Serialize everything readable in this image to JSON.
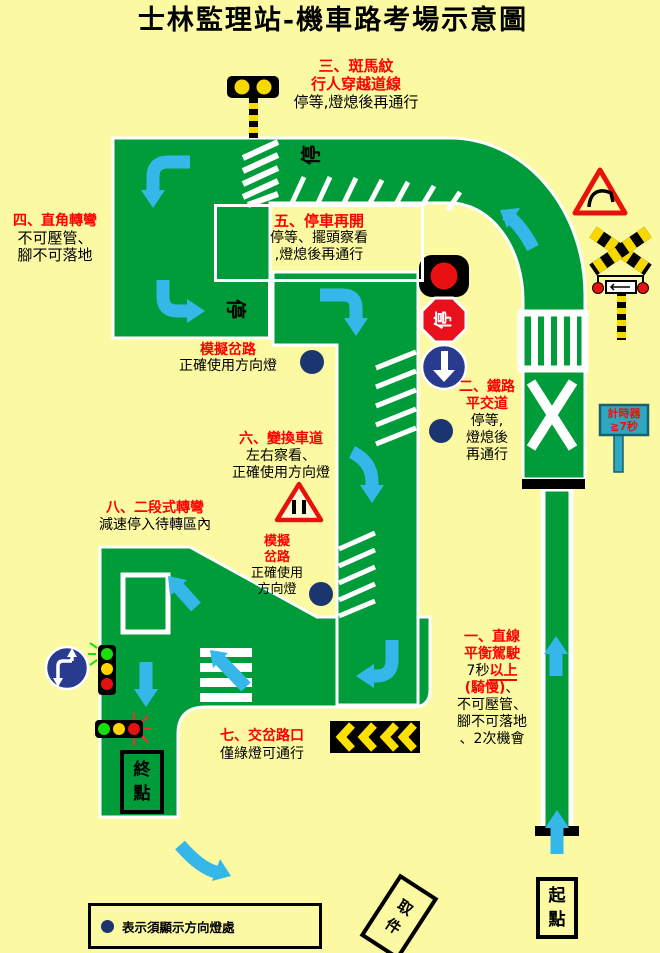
{
  "title": "士林監理站-機車路考場示意圖",
  "sections": {
    "s1": {
      "h1": "一、直線",
      "h2": "平衡駕駛",
      "b1a": "7秒",
      "b1b": "以上",
      "b2a": "(騎慢)",
      "b2b": "、",
      "b3": "不可壓管、",
      "b4": "腳不可落地",
      "b5": "、2次機會"
    },
    "s2": {
      "h1": "二、鐵路",
      "h2": "平交道",
      "b1": "停等,",
      "b2": "燈熄後",
      "b3": "再通行"
    },
    "s3": {
      "h1": "三、斑馬紋",
      "h2": "行人穿越道線",
      "b1": "停等,燈熄後再通行"
    },
    "s4": {
      "h1": "四、直角轉彎",
      "b1": "不可壓管、",
      "b2": "腳不可落地"
    },
    "s5": {
      "h1": "五、停車再開",
      "b1": "停等、擺頭察看",
      "b2": ",燈熄後再通行"
    },
    "s6": {
      "h1": "六、變換車道",
      "b1": "左右察看、",
      "b2": "正確使用方向燈"
    },
    "s7": {
      "h1": "七、交岔路口",
      "b1": "僅綠燈可通行"
    },
    "s8": {
      "h1": "八、二段式轉彎",
      "b1": "減速停入待轉區內"
    },
    "sim1": {
      "h1": "模擬岔路",
      "b1": "正確使用方向燈"
    },
    "sim2": {
      "h1": "模擬",
      "h2": "岔路",
      "b1": "正確使用",
      "b2": "方向燈"
    }
  },
  "road_words": {
    "stop_top": "停",
    "stop_left": "停"
  },
  "signs": {
    "stop_sign": "停",
    "timer_line1": "計時器",
    "timer_line2": "≧7秒"
  },
  "markers": {
    "start": [
      "起",
      "點"
    ],
    "end": [
      "終",
      "點"
    ],
    "pickup": [
      "取",
      "件"
    ]
  },
  "legend": {
    "text": "表示須顯示方向燈處"
  },
  "colors": {
    "background": "#FBF9A1",
    "road_green": "#009C3A",
    "arrow_blue": "#36B7EA",
    "signal_dot_navy": "#1B3570",
    "heading_red": "#FF0000",
    "timer_board_cyan": "#2FA8BF"
  }
}
